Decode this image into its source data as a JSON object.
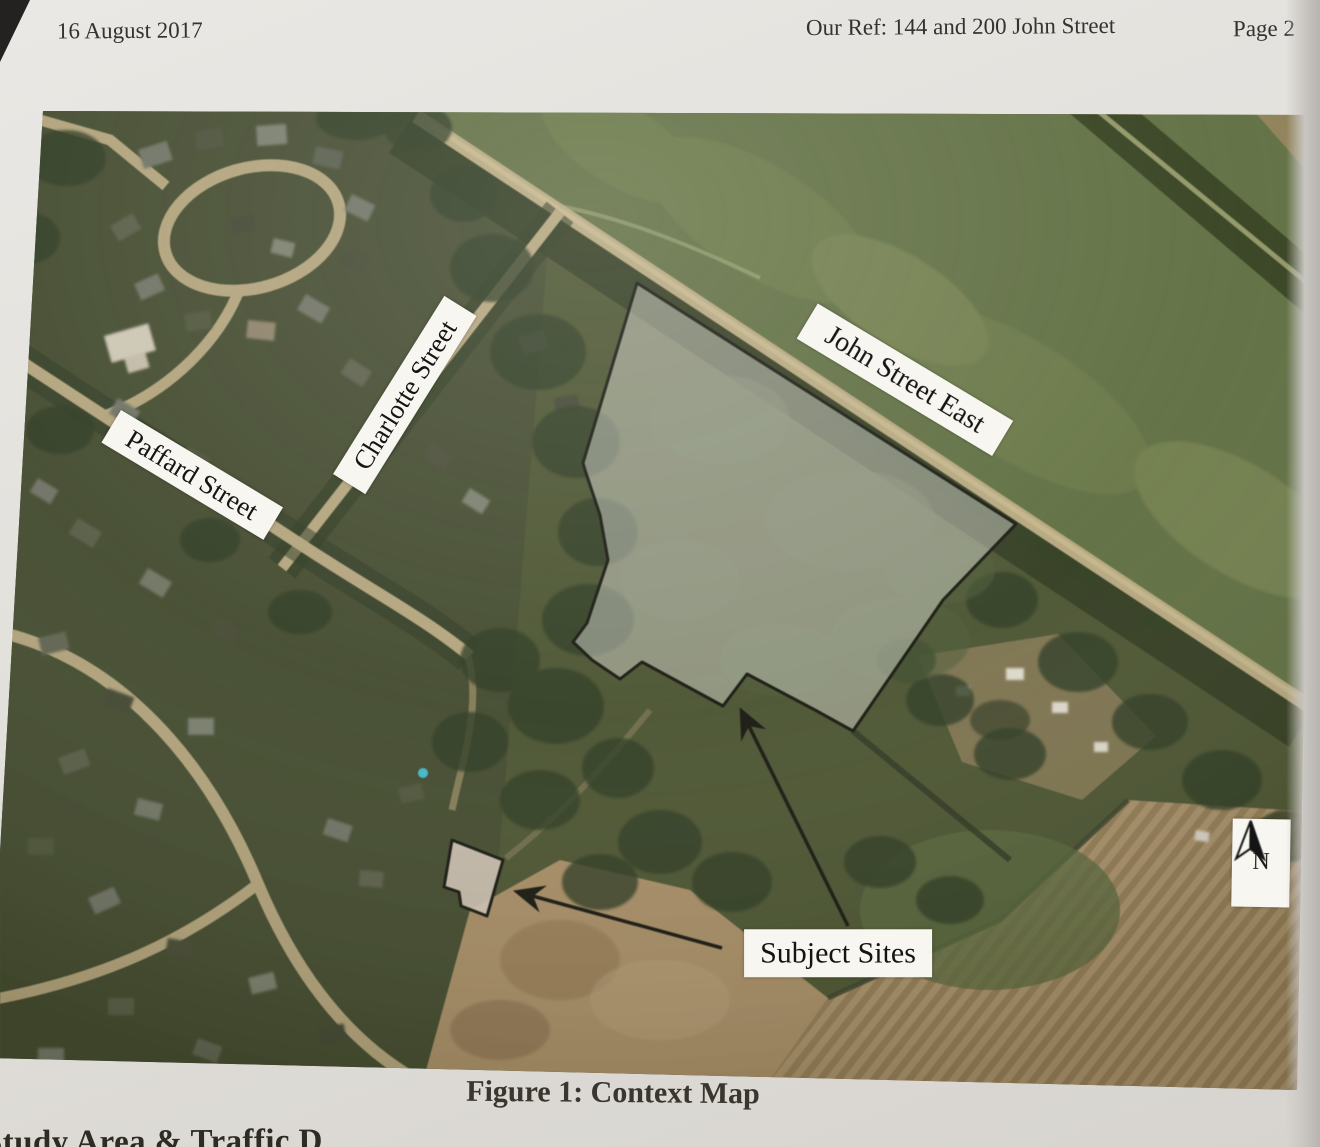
{
  "header": {
    "date": "16 August 2017",
    "reference": "Our Ref: 144 and 200 John Street",
    "page_number": "Page 2"
  },
  "map": {
    "street_labels": {
      "paffard": "Paffard Street",
      "charlotte": "Charlotte Street",
      "john": "John Street East"
    },
    "subject_sites_label": "Subject Sites",
    "north_label": "N"
  },
  "figure_caption": "Figure 1: Context Map",
  "next_section_heading_partial": "Study Area & Traffic D",
  "colors": {
    "site_outline": "#17170f",
    "site_fill_overlay": "rgba(225,225,218,0.45)",
    "label_background": "#f7f6f1",
    "road_tan": "#b6a77e",
    "field_green": "#5f6e41",
    "plowed_brown": "#a8906a"
  }
}
